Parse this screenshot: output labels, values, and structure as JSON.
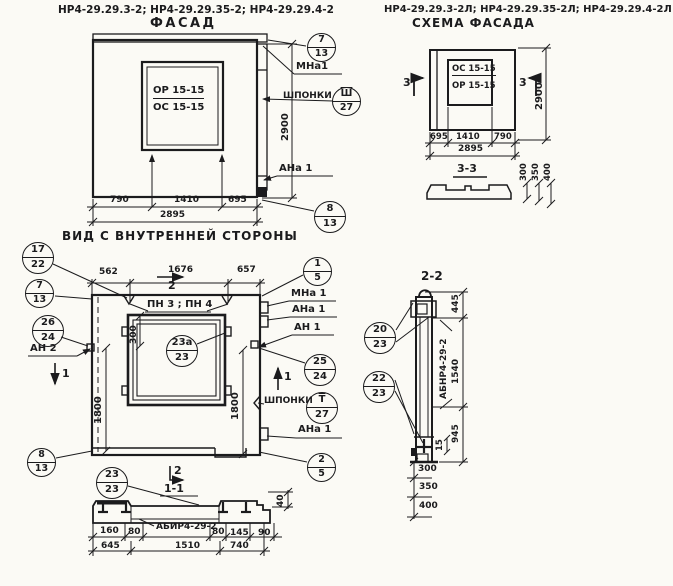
{
  "facade": {
    "codes": "НР4-29.29.3-2; НР4-29.29.35-2; НР4-29.29.4-2",
    "title": "ФАСАД",
    "window_top": "ОР 15-15",
    "window_bottom": "ОС 15-15",
    "caption": "ВИД С ВНУТРЕННЕЙ СТОРОНЫ",
    "dims": {
      "w1": "790",
      "w2": "1410",
      "w3": "695",
      "total": "2895",
      "height": "2900"
    },
    "labels": {
      "mna1": "МНа1",
      "shponki": "ШПОНКИ",
      "ana1": "АНа 1"
    },
    "callouts": {
      "mount_top": {
        "top": "7",
        "bottom": "13"
      },
      "shponka": {
        "top": "Ш",
        "bottom": "27"
      },
      "mount_bottom": {
        "top": "8",
        "bottom": "13"
      }
    }
  },
  "schema": {
    "codes": "НР4-29.29.3-2Л; НР4-29.29.35-2Л; НР4-29.29.4-2Л",
    "title": "СХЕМА ФАСАДА",
    "window_top": "ОС 15-15",
    "window_bottom": "ОР 15-15",
    "section_mark": "3",
    "section_title": "3-3",
    "dims": {
      "w1": "695",
      "w2": "1410",
      "w3": "790",
      "total": "2895",
      "height": "2900"
    },
    "profile_dims": {
      "d1": "300",
      "d2": "350",
      "d3": "400"
    }
  },
  "inner": {
    "dims": {
      "t1": "562",
      "t2": "1676",
      "t3": "657",
      "win": "300",
      "left_h": "1800",
      "right_h": "1800"
    },
    "labels": {
      "pn": "ПН 3 ; ПН 4",
      "an2": "АН 2",
      "mna1": "МНа 1",
      "ana1": "АНа 1",
      "an1": "АН 1",
      "shponki": "ШПОНКИ",
      "ana1b": "АНа 1"
    },
    "marks": {
      "top2": "2",
      "left1": "1",
      "right1": "1",
      "bottom2": "2",
      "bottom_title": "1-1"
    },
    "callouts": {
      "c17_22": {
        "top": "17",
        "bottom": "22"
      },
      "c7_13": {
        "top": "7",
        "bottom": "13"
      },
      "c26_24": {
        "top": "26",
        "bottom": "24"
      },
      "c8_13": {
        "top": "8",
        "bottom": "13"
      },
      "c1_5": {
        "top": "1",
        "bottom": "5"
      },
      "c25_24": {
        "top": "25",
        "bottom": "24"
      },
      "t_27": {
        "top": "Т",
        "bottom": "27"
      },
      "c23a_23": {
        "top": "23а",
        "bottom": "23"
      },
      "c23_23": {
        "top": "23",
        "bottom": "23"
      },
      "c2_5": {
        "top": "2",
        "bottom": "5"
      }
    }
  },
  "s11": {
    "beam_mark": "АБИР4-29-2",
    "dims": {
      "a160": "160",
      "a80": "80",
      "b80": "80",
      "a145": "145",
      "a90": "90",
      "a645": "645",
      "a1510": "1510",
      "a740": "740",
      "a40": "40"
    }
  },
  "s22": {
    "title": "2-2",
    "beam_mark": "АБНР4-29-2",
    "dims": {
      "a445": "445",
      "a1540": "1540",
      "a945": "945",
      "a15": "15",
      "a300": "300",
      "a350": "350",
      "a400": "400"
    },
    "callouts": {
      "c20_23": {
        "top": "20",
        "bottom": "23"
      },
      "c22_23": {
        "top": "22",
        "bottom": "23"
      }
    }
  }
}
